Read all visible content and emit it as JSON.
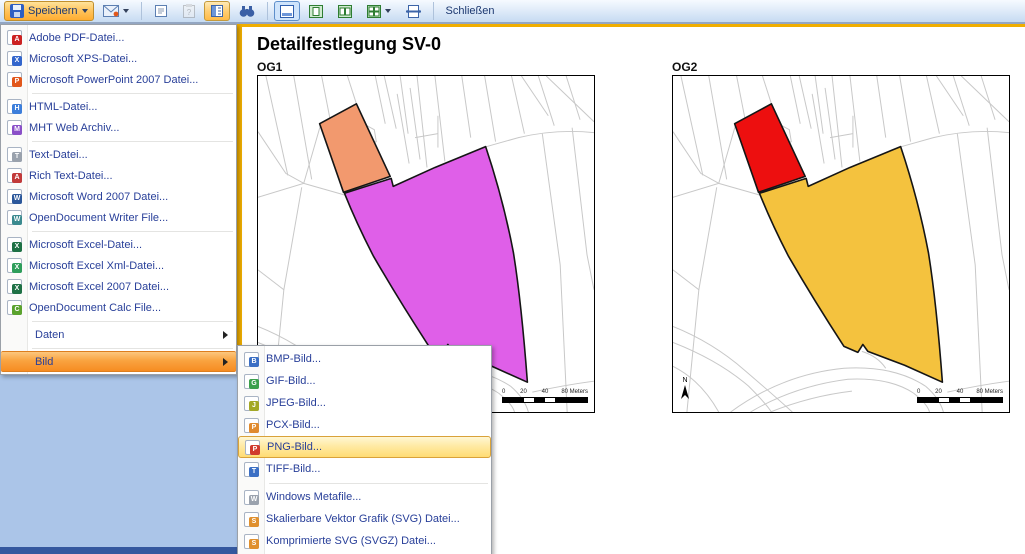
{
  "toolbar": {
    "save_label": "Speichern",
    "close_label": "Schließen"
  },
  "menu": {
    "items": [
      {
        "name": "adobe-pdf",
        "label": "Adobe PDF-Datei...",
        "icon": "pdf-file-icon",
        "color": "#CC2222",
        "letter": "A"
      },
      {
        "name": "ms-xps",
        "label": "Microsoft XPS-Datei...",
        "icon": "xps-file-icon",
        "color": "#3366CC",
        "letter": "X"
      },
      {
        "name": "ms-powerpoint-2007",
        "label": "Microsoft PowerPoint 2007 Datei...",
        "icon": "powerpoint-file-icon",
        "color": "#E2571B",
        "letter": "P",
        "separator_after": true
      },
      {
        "name": "html",
        "label": "HTML-Datei...",
        "icon": "html-file-icon",
        "color": "#3C7EDB",
        "letter": "H"
      },
      {
        "name": "mht",
        "label": "MHT Web Archiv...",
        "icon": "mht-file-icon",
        "color": "#8A4FC8",
        "letter": "M",
        "separator_after": true
      },
      {
        "name": "text",
        "label": "Text-Datei...",
        "icon": "text-file-icon",
        "color": "#9AA2AD",
        "letter": "T"
      },
      {
        "name": "rich-text",
        "label": "Rich Text-Datei...",
        "icon": "rtf-file-icon",
        "color": "#C23A3A",
        "letter": "A"
      },
      {
        "name": "ms-word-2007",
        "label": "Microsoft Word 2007 Datei...",
        "icon": "word-file-icon",
        "color": "#2B579A",
        "letter": "W"
      },
      {
        "name": "odt-writer",
        "label": "OpenDocument Writer File...",
        "icon": "odt-file-icon",
        "color": "#3B8A8F",
        "letter": "W",
        "separator_after": true
      },
      {
        "name": "ms-excel",
        "label": "Microsoft Excel-Datei...",
        "icon": "excel-file-icon",
        "color": "#1E7145",
        "letter": "X"
      },
      {
        "name": "ms-excel-xml",
        "label": "Microsoft Excel Xml-Datei...",
        "icon": "excel-xml-file-icon",
        "color": "#2E9E5B",
        "letter": "X"
      },
      {
        "name": "ms-excel-2007",
        "label": "Microsoft Excel 2007 Datei...",
        "icon": "excel-2007-file-icon",
        "color": "#1E7145",
        "letter": "X"
      },
      {
        "name": "ods-calc",
        "label": "OpenDocument Calc File...",
        "icon": "ods-file-icon",
        "color": "#5BA32E",
        "letter": "C",
        "separator_after": true
      },
      {
        "name": "daten",
        "label": "Daten",
        "has_submenu": true,
        "separator_after": true
      },
      {
        "name": "bild",
        "label": "Bild",
        "has_submenu": true,
        "highlighted": true
      }
    ]
  },
  "submenu": {
    "items": [
      {
        "name": "bmp",
        "label": "BMP-Bild...",
        "icon": "bmp-file-icon",
        "color": "#3B6FC4",
        "letter": "B"
      },
      {
        "name": "gif",
        "label": "GIF-Bild...",
        "icon": "gif-file-icon",
        "color": "#3BA04C",
        "letter": "G"
      },
      {
        "name": "jpeg",
        "label": "JPEG-Bild...",
        "icon": "jpeg-file-icon",
        "color": "#A3A825",
        "letter": "J"
      },
      {
        "name": "pcx",
        "label": "PCX-Bild...",
        "icon": "pcx-file-icon",
        "color": "#E08A2E",
        "letter": "P"
      },
      {
        "name": "png",
        "label": "PNG-Bild...",
        "icon": "png-file-icon",
        "color": "#D03A2E",
        "letter": "P",
        "highlighted": true
      },
      {
        "name": "tiff",
        "label": "TIFF-Bild...",
        "icon": "tiff-file-icon",
        "color": "#3B6FC4",
        "letter": "T",
        "separator_after": true
      },
      {
        "name": "wmf",
        "label": "Windows Metafile...",
        "icon": "wmf-file-icon",
        "color": "#9AA2AD",
        "letter": "W"
      },
      {
        "name": "svg",
        "label": "Skalierbare Vektor Grafik (SVG) Datei...",
        "icon": "svg-file-icon",
        "color": "#E0902E",
        "letter": "S"
      },
      {
        "name": "svgz",
        "label": "Komprimierte SVG (SVGZ) Datei...",
        "icon": "svgz-file-icon",
        "color": "#E0902E",
        "letter": "S"
      }
    ]
  },
  "page": {
    "title": "Detailfestlegung SV-0",
    "north_label": "N",
    "scalebar": {
      "t0": "0",
      "t20": "20",
      "t40": "40",
      "t80": "80 Meters"
    },
    "panels": [
      {
        "label": "OG1",
        "small_fill": "#F2996E",
        "big_fill": "#DF5FE8"
      },
      {
        "label": "OG2",
        "small_fill": "#ED0F0F",
        "big_fill": "#F4C23E"
      }
    ]
  },
  "map": {
    "line_color": "#C8C8C8",
    "outline_color": "#151515",
    "bg_lines": [
      "M8,0 L30,100",
      "M36,0 L54,104",
      "M64,0 L73,46",
      "M90,0 L99,28",
      "M118,0 L128,48",
      "M127,0 L139,53",
      "M143,0 L151,58",
      "M160,0 L170,92",
      "M178,0 L188,86",
      "M205,0 L214,62",
      "M228,0 L239,66",
      "M255,0 L268,58",
      "M282,0 L298,50",
      "M310,0 L324,44",
      "M0,122 L46,108 L63,49",
      "M46,108 L88,120",
      "M0,56 L28,98 L46,108",
      "M44,112 L26,215 L14,338",
      "M0,195 L26,215",
      "M104,47 L117,54 L119,66 L107,70 L104,47",
      "M140,18 L152,88",
      "M153,12 L163,84",
      "M158,62 L181,58",
      "M181,40 L181,72",
      "M230,71 L262,62 Q300,53 338,57",
      "M286,58 L304,190 L311,338",
      "M316,52 L331,180 L338,215",
      "M290,0 L338,46",
      "M265,0 L292,40",
      "M0,252 Q40,268 72,296 Q100,320 120,338",
      "M0,268 Q46,286 76,312 Q94,330 99,338",
      "M0,292 Q28,306 46,338",
      "M58,338 Q110,300 172,294 Q222,291 254,312",
      "M78,338 Q122,312 176,305 Q218,303 242,319",
      "M98,338 Q138,322 180,317",
      "M254,312 Q268,324 272,338",
      "M242,319 Q256,330 258,338",
      "M276,318 Q308,311 338,307",
      "M190,277 Q206,282 214,294"
    ],
    "small_polygon": "M62,48 L99,28 L133,101 L86,117 Z",
    "big_polygon": "M87,118 L134,103 L136,111 L178,92 L229,71 Q247,125 257,178 Q265,228 271,308 L233,291 L196,277 L191,270 L186,278 L172,272 Q142,226 116,181 Q99,148 87,118 Z"
  }
}
